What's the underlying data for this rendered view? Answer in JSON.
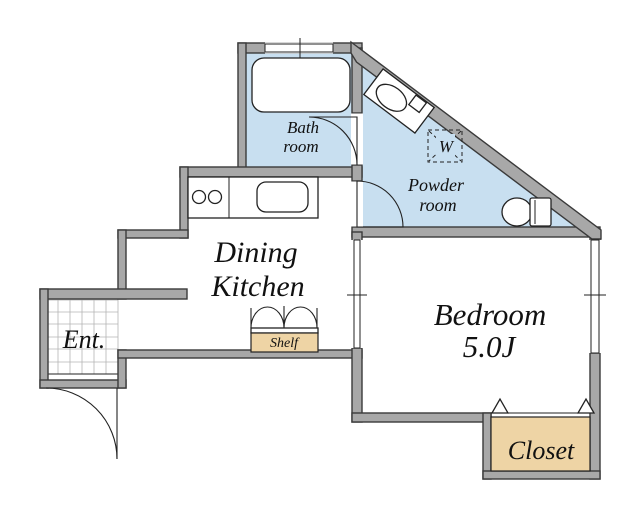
{
  "title": "Apartment floor plan",
  "colors": {
    "wall_fill": "#a8a8a8",
    "wall_edge": "#3a3a3a",
    "floor_blue": "#c8dff0",
    "wood_tan": "#eed4a5",
    "outline": "#222222",
    "tile_line": "#b5b5b5",
    "text": "#111111"
  },
  "rooms": {
    "bath": {
      "line1": "Bath",
      "line2": "room"
    },
    "powder": {
      "line1": "Powder",
      "line2": "room"
    },
    "dining_kitchen": {
      "line1": "Dining",
      "line2": "Kitchen"
    },
    "bedroom": {
      "name": "Bedroom",
      "size": "5.0J"
    },
    "entrance": {
      "label": "Ent."
    },
    "closet": {
      "label": "Closet"
    },
    "shelf": {
      "label": "Shelf"
    },
    "washer": {
      "label": "W"
    }
  }
}
